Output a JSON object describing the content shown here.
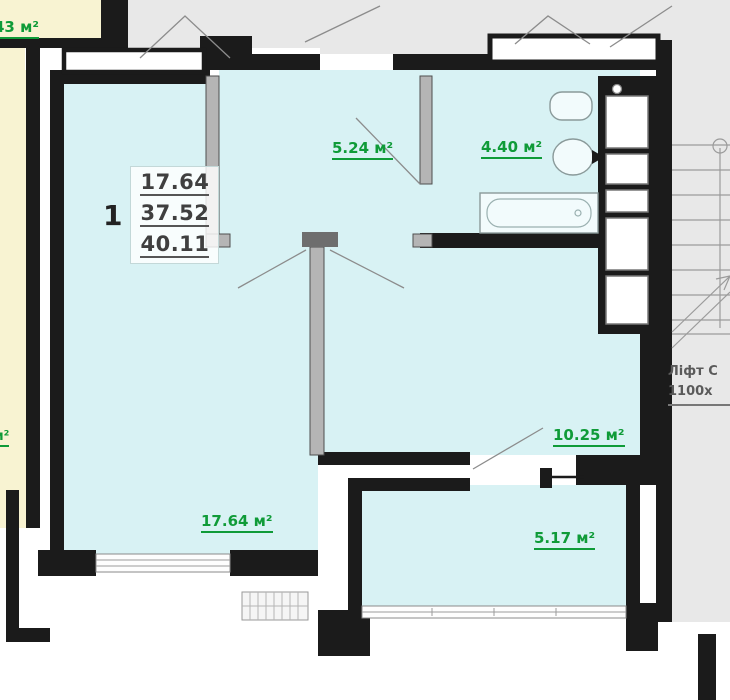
{
  "apartment": {
    "number": "1",
    "areas": [
      "17.64",
      "37.52",
      "40.11"
    ]
  },
  "room_labels": {
    "hallway": "5.24 м²",
    "bathroom": "4.40 м²",
    "kitchen": "10.25 м²",
    "living": "17.64 м²",
    "balcony": "5.17 м²"
  },
  "neighbor_labels": {
    "top_left": "43 м²",
    "left_edge": "м²"
  },
  "stairwell": {
    "elevator_line1": "Ліфт С",
    "elevator_line2": "1100х"
  },
  "colors": {
    "room_fill": "#d8f2f4",
    "neighbor_fill": "#f8f3d2",
    "corridor_fill": "#e8e8e8",
    "wall": "#1b1b1b",
    "partition": "#b5b5b5",
    "label_green": "#0f9b38"
  }
}
